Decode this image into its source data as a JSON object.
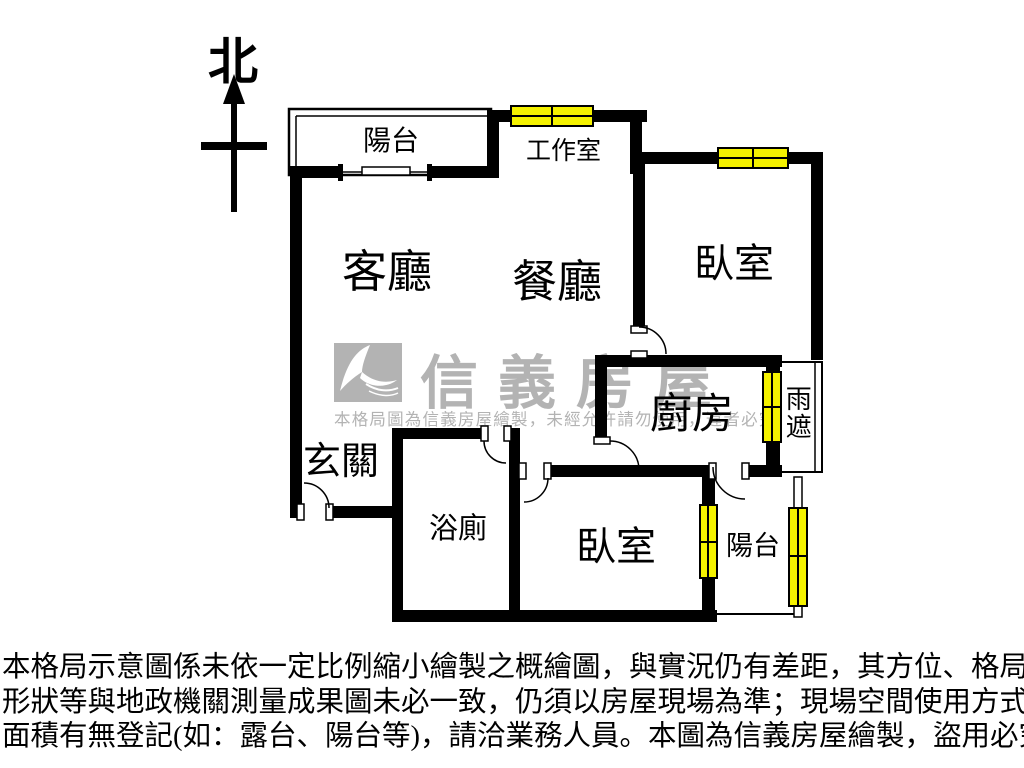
{
  "compass": {
    "north_label": "北"
  },
  "rooms": {
    "balcony_top": "陽台",
    "workroom": "工作室",
    "living_room": "客廳",
    "dining_room": "餐廳",
    "bedroom_top_right": "臥室",
    "kitchen": "廚房",
    "rain_shelter": "雨遮",
    "entrance": "玄關",
    "bathroom": "浴廁",
    "bedroom_bottom": "臥室",
    "balcony_bottom": "陽台"
  },
  "watermark": {
    "brand_name": "信義房屋",
    "notice": "本格局圖為信義房屋繪製，未經允許請勿使用，違者必究"
  },
  "disclaimer_lines": [
    "本格局示意圖係未依一定比例縮小繪製之概繪圖，與實況仍有差距，其方位、格局、",
    "形狀等與地政機關測量成果圖未必一致，仍須以房屋現場為準；現場空間使用方式及",
    "面積有無登記(如：露台、陽台等)，請洽業務人員。本圖為信義房屋繪製，盜用必究。"
  ],
  "colors": {
    "wall": "#000000",
    "window_fill": "#f5f200",
    "watermark_gray": "#b3b3b3",
    "background": "#ffffff"
  }
}
